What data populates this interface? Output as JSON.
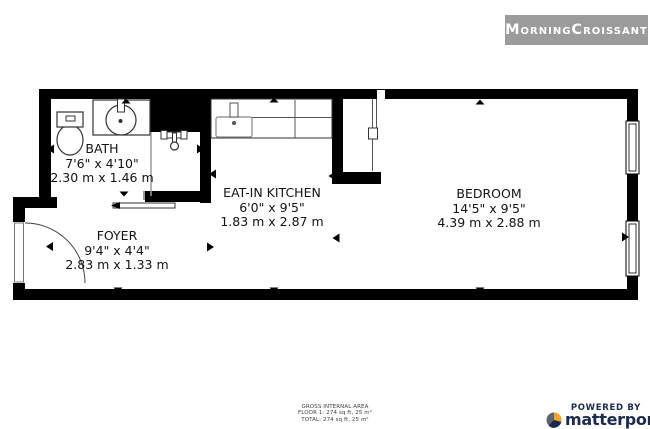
{
  "header": {
    "brand": "MorningCroissant"
  },
  "rooms": [
    {
      "name": "BATH",
      "imperial": "7'6\" x 4'10\"",
      "metric": "2.30 m x 1.46 m"
    },
    {
      "name": "EAT-IN KITCHEN",
      "imperial": "6'0\" x 9'5\"",
      "metric": "1.83 m x 2.87 m"
    },
    {
      "name": "BEDROOM",
      "imperial": "14'5\" x 9'5\"",
      "metric": "4.39 m x 2.88 m"
    },
    {
      "name": "FOYER",
      "imperial": "9'4\" x 4'4\"",
      "metric": "2.83 m x 1.33 m"
    }
  ],
  "area_summary": {
    "title": "GROSS INTERNAL AREA",
    "floor": "FLOOR 1: 274 sq ft, 25 m²",
    "total": "TOTAL: 274 sq ft, 25 m²"
  },
  "attribution": {
    "powered_by": "POWERED BY",
    "brand": "matterport",
    "trademark": "™"
  },
  "colors": {
    "wall": "#000000",
    "brand_box_bg": "#9b9b9b",
    "brand_text": "#ffffff",
    "matterport_navy": "#1b2a4e",
    "matterport_orange": "#f6a623",
    "matterport_gray": "#5b6570"
  }
}
